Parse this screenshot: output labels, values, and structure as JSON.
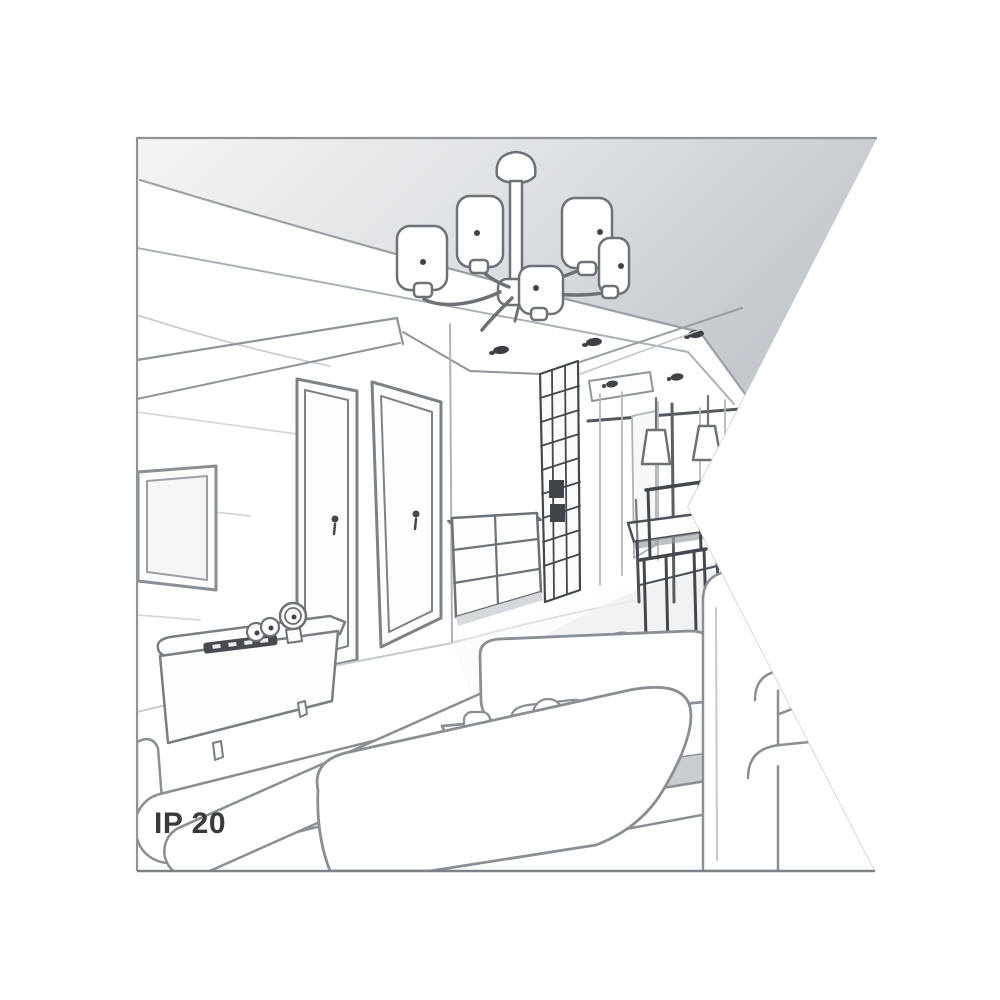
{
  "illustration": {
    "label": "IP 20",
    "type": "interior-perspective-line-drawing",
    "colors": {
      "background": "#ffffff",
      "outline": "#787d82",
      "outline_dark": "#43484d",
      "outline_light": "#b8bdc1",
      "ceiling_shade": "#c6cbd0",
      "floor_shade": "#e2e5e8",
      "text": "#3a3a3a",
      "border": "#8f9499"
    },
    "scene_elements": [
      "ceiling",
      "chandelier",
      "recessed-spotlights",
      "cornice",
      "tv-panel",
      "media-sideboard",
      "clock",
      "remote-control",
      "interior-door",
      "interior-door",
      "chest-of-drawers",
      "lattice-screen",
      "hallway",
      "pendant-lamps",
      "dining-table",
      "dining-chairs",
      "rug",
      "sofa",
      "ottoman",
      "coffee-table",
      "armrest-sofa"
    ]
  }
}
